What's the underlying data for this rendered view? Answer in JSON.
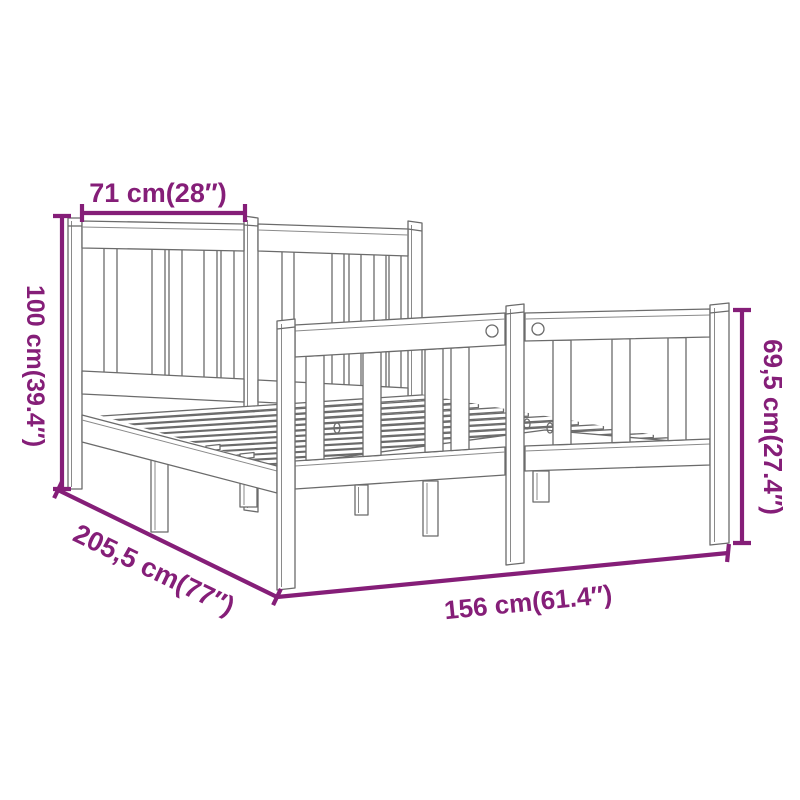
{
  "diagram": {
    "subject": "wooden bed frame line drawing with dimension annotations",
    "labels": {
      "headboard_width_top": "71 cm(28″)",
      "headboard_height_left": "100 cm(39.4″)",
      "frame_length_diagonal": "205,5 cm(77″)",
      "frame_width_bottom": "156 cm(61.4″)",
      "footboard_height_right": "69,5 cm(27.4″)"
    },
    "colors": {
      "dimension_accent": "#851e78",
      "line_art": "#6b6b6b",
      "background": "#ffffff"
    }
  }
}
